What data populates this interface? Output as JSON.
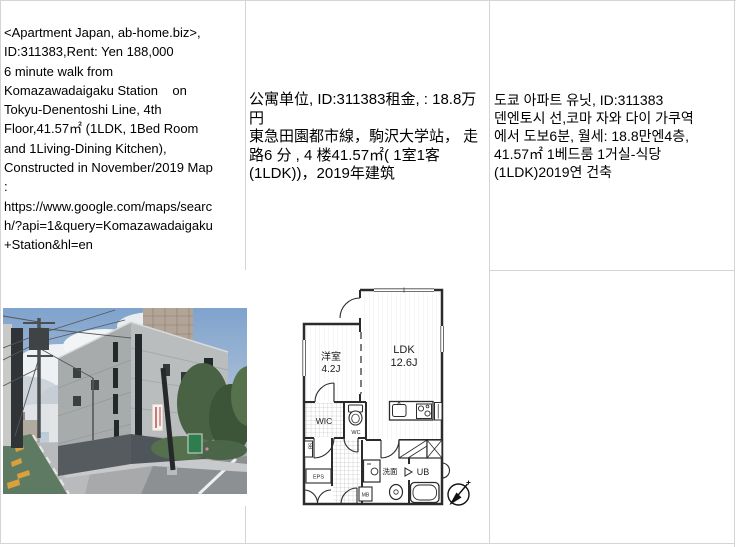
{
  "table": {
    "grid_color": "#d4d4d4",
    "cells": {
      "english": {
        "text": "<Apartment Japan, ab-home.biz>,\nID:311383,Rent: Yen 188,000\n6 minute walk from\nKomazawadaigaku Station    on\nTokyu-Denentoshi Line, 4th\nFloor,41.57㎡ (1LDK, 1Bed Room\nand 1Living-Dining Kitchen),\nConstructed in November/2019 Map\n:\nhttps://www.google.com/maps/searc\nh/?api=1&query=Komazawadaigaku\n+Station&hl=en"
      },
      "chinese": {
        "text": "公寓单位, ID:311383租金, : 18.8万\n円\n東急田園都市線，駒沢大学站， 走\n路6 分 , 4 楼41.57㎡( 1室1客\n(1LDK))，2019年建筑"
      },
      "korean": {
        "text": "도쿄 아파트 유닛, ID:311383\n덴엔토시 선,코마 자와 다이 가쿠역\n에서 도보6분, 월세: 18.8만엔4층,\n41.57㎡ 1베드룸 1거실-식당\n(1LDK)2019연 건축"
      }
    }
  },
  "floorplan": {
    "wall_color": "#2b2b2b",
    "labels": {
      "living": "LDK",
      "living_size": "12.6J",
      "bedroom": "洋室",
      "bedroom_size": "4.2J",
      "walk_in_closet": "WIC",
      "toilet": "WC",
      "washroom": "洗面",
      "unit_bath": "UB",
      "pipe_space": "EPS",
      "meter_box": "MB",
      "shoe_box": "SB"
    }
  },
  "photo": {
    "palette": {
      "sky": "#88a9cf",
      "building_concrete": "#b4b7b8",
      "bike_lane_green": "#5f7a63",
      "lane_marking_yellow": "#d9a13b"
    }
  }
}
